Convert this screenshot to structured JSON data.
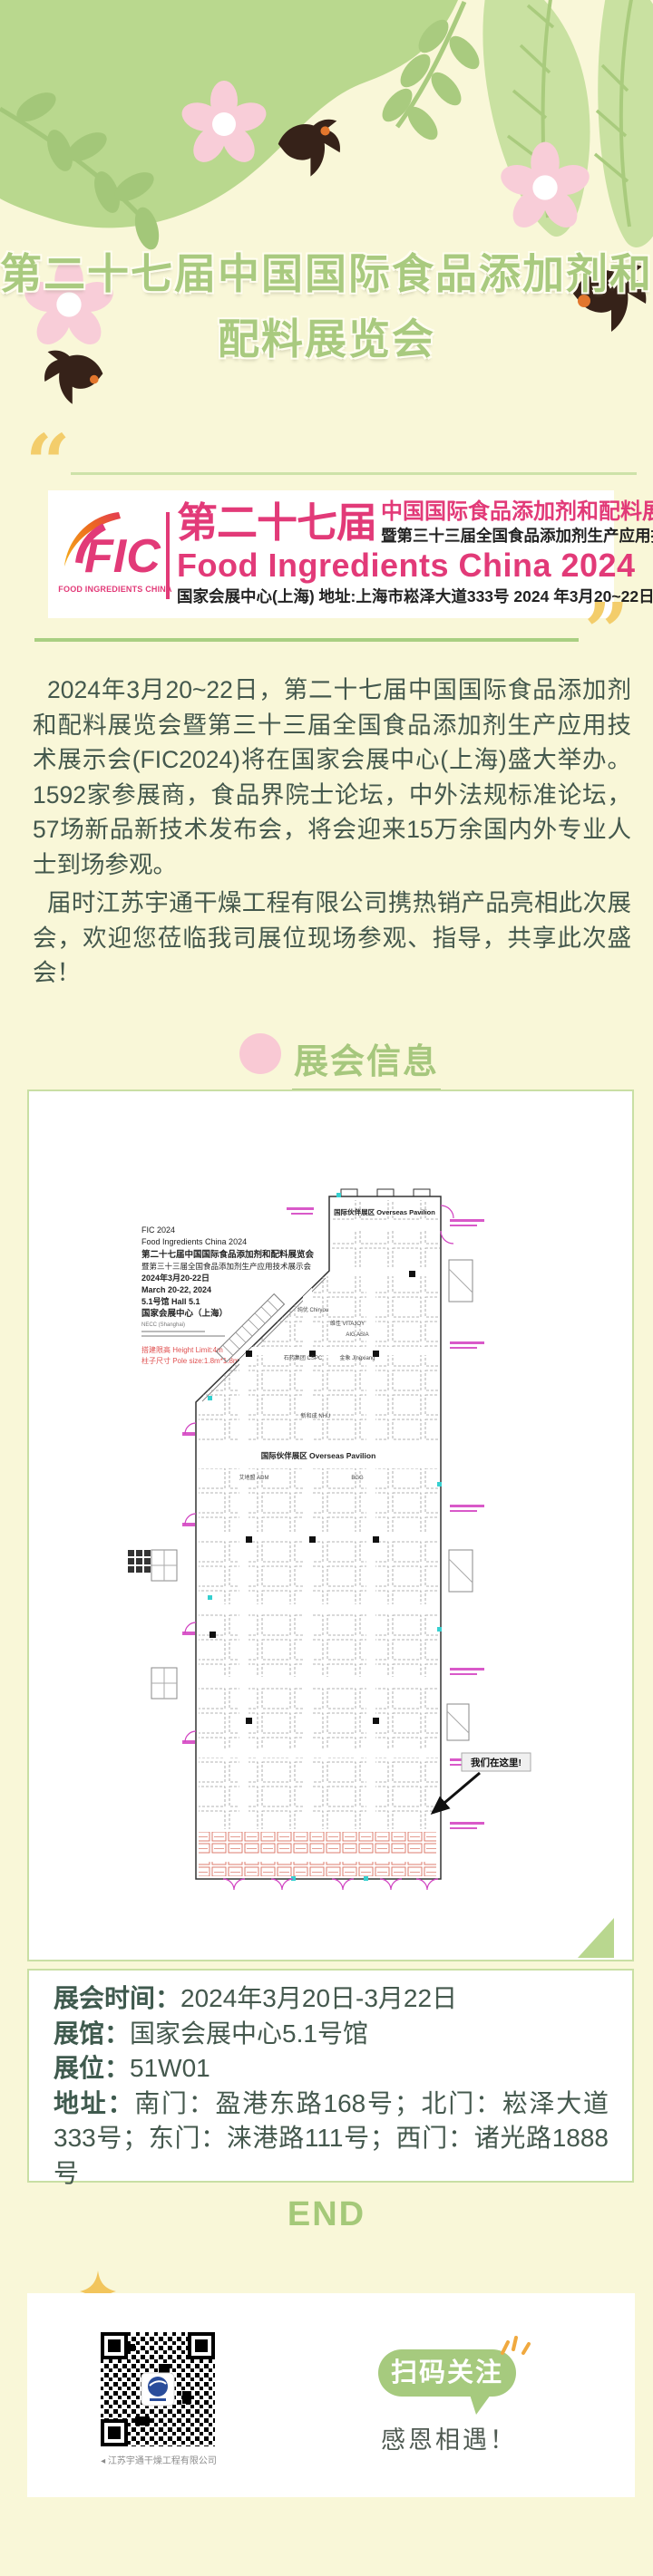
{
  "title": {
    "line1": "第二十七届中国国际食品添加剂和",
    "line2": "配料展览会",
    "color": "#a9ca7f"
  },
  "banner": {
    "logo_text": "FIC",
    "logo_caption": "FOOD INGREDIENTS CHINA",
    "title_cn_big": "第二十七届",
    "title_cn": "中国国际食品添加剂和配料展览会",
    "subtitle_cn": "暨第三十三届全国食品添加剂生产应用技术展示会",
    "title_en": "Food Ingredients China 2024",
    "venue_line": "国家会展中心(上海) 地址:上海市崧泽大道333号 2024 年3月20~22日",
    "accent_pink": "#e23a78"
  },
  "intro": {
    "p1": "2024年3月20~22日，第二十七届中国国际食品添加剂和配料展览会暨第三十三届全国食品添加剂生产应用技术展示会(FIC2024)将在国家会展中心(上海)盛大举办。1592家参展商，食品界院士论坛，中外法规标准论坛，57场新品新技术发布会，将会迎来15万余国内外专业人士到场参观。",
    "p2": "届时江苏宇通干燥工程有限公司携热销产品亮相此次展会，欢迎您莅临我司展位现场参观、指导，共享此次盛会！"
  },
  "section": {
    "title": "展会信息"
  },
  "floorplan": {
    "header_lines": [
      "FIC 2024",
      "Food Ingredients China 2024",
      "第二十七届中国国际食品添加剂和配料展览会",
      "暨第三十三届全国食品添加剂生产应用技术展示会",
      "2024年3月20-22日",
      "March 20-22, 2024",
      "5.1号馆  Hall 5.1",
      "国家会展中心（上海）",
      "NECC (Shanghai)"
    ],
    "note1": "搭建限高 Height Limit:4m",
    "note2": "柱子尺寸 Pole size:1.8m*1.8m",
    "pavilion_top": "国际伙伴展区  Overseas Pavilion",
    "pavilion_mid": "国际伙伴展区  Overseas Pavilion",
    "callout": "我们在这里!",
    "booth_labels": [
      "纯优 Chiryou",
      "维佳 VITAJOY",
      "AIG ASIA",
      "石药集团 CSPC",
      "金象 Jingxiang",
      "新和成 NHU",
      "艾地盟 ADM",
      "BGG"
    ]
  },
  "info": {
    "rows": [
      {
        "label": "展会时间：",
        "value": "2024年3月20日-3月22日"
      },
      {
        "label": "展馆：",
        "value": "国家会展中心5.1号馆"
      },
      {
        "label": "展位：",
        "value": "51W01"
      },
      {
        "label": "地址：",
        "value": "南门：盈港东路168号；北门：崧泽大道333号；东门：涞港路111号；西门：诸光路1888号"
      }
    ]
  },
  "end_label": "END",
  "footer": {
    "follow_button": "扫码关注",
    "thanks": "感恩相遇！",
    "qr_caption": "江苏宇通干燥工程有限公司"
  }
}
